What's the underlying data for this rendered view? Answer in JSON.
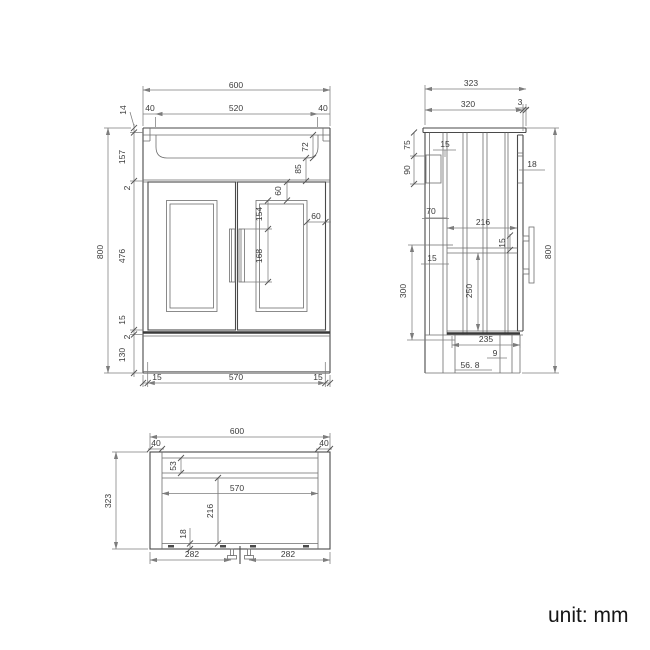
{
  "unit_label": "unit: mm",
  "front": {
    "overall_width": "600",
    "left_overhang": "40",
    "basin_width": "520",
    "right_overhang": "40",
    "counter_thickness": "14",
    "upper_section_height": "157",
    "top_reveal": "2",
    "door_height": "476",
    "bottom_rail": "15",
    "bottom_reveal": "2",
    "plinth_height": "130",
    "overall_height": "800",
    "basin_depth": "72",
    "apron_height": "85",
    "panel_top_inset": "60",
    "handle_top_offset": "154",
    "handle_length": "168",
    "panel_side_inset": "60",
    "bottom_left_inset": "15",
    "door_opening_width": "570",
    "bottom_right_inset": "15"
  },
  "side": {
    "overall_depth": "323",
    "top_depth": "320",
    "front_overhang": "3",
    "bracket_top_offset": "75",
    "bracket_height": "90",
    "back_panel_inset": "15",
    "upper_clearance": "70",
    "door_thickness": "18",
    "inner_depth": "216",
    "rail_thickness": "15",
    "partition_inset": "15",
    "lower_inner_height": "250",
    "mid_section_height": "300",
    "bottom_inner_depth": "235",
    "leg_front_inset": "9",
    "leg_offset": "56. 8",
    "overall_height": "800"
  },
  "plan": {
    "overall_width": "600",
    "left_panel_thickness": "40",
    "right_panel_thickness": "40",
    "overall_depth": "323",
    "back_rail_depth": "53",
    "inner_width": "570",
    "inner_depth": "216",
    "front_rail_depth": "18",
    "left_handle_span": "282",
    "right_handle_span": "282"
  }
}
